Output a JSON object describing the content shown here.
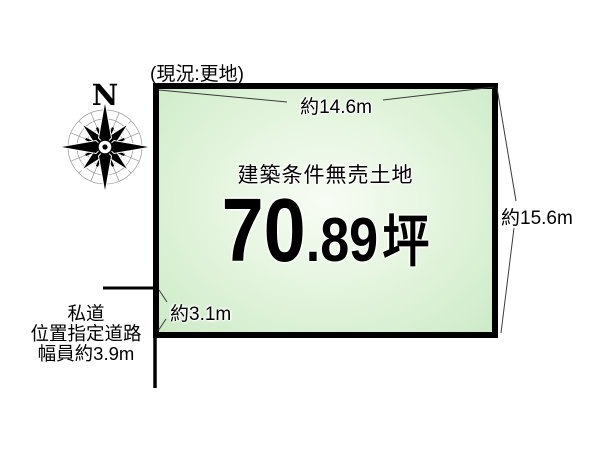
{
  "title_note": "(現況:更地)",
  "compass": {
    "label": "N"
  },
  "parcel": {
    "condition": "建築条件無売土地",
    "area_int": "70",
    "area_frac": ".89",
    "area_unit": "坪"
  },
  "dims": {
    "top": "約14.6m",
    "right": "約15.6m",
    "frontage": "約3.1m"
  },
  "road": {
    "line1": "私道",
    "line2": "位置指定道路",
    "line3": "幅員約3.9m"
  },
  "colors": {
    "fill_edge": "#cdeac8",
    "fill_mid": "#e2f4dc",
    "fill_center": "#f8fcf5",
    "border": "#000000",
    "leader": "#3a3a3a",
    "road_line": "#000000",
    "compass_web": "#9a9a9a"
  }
}
